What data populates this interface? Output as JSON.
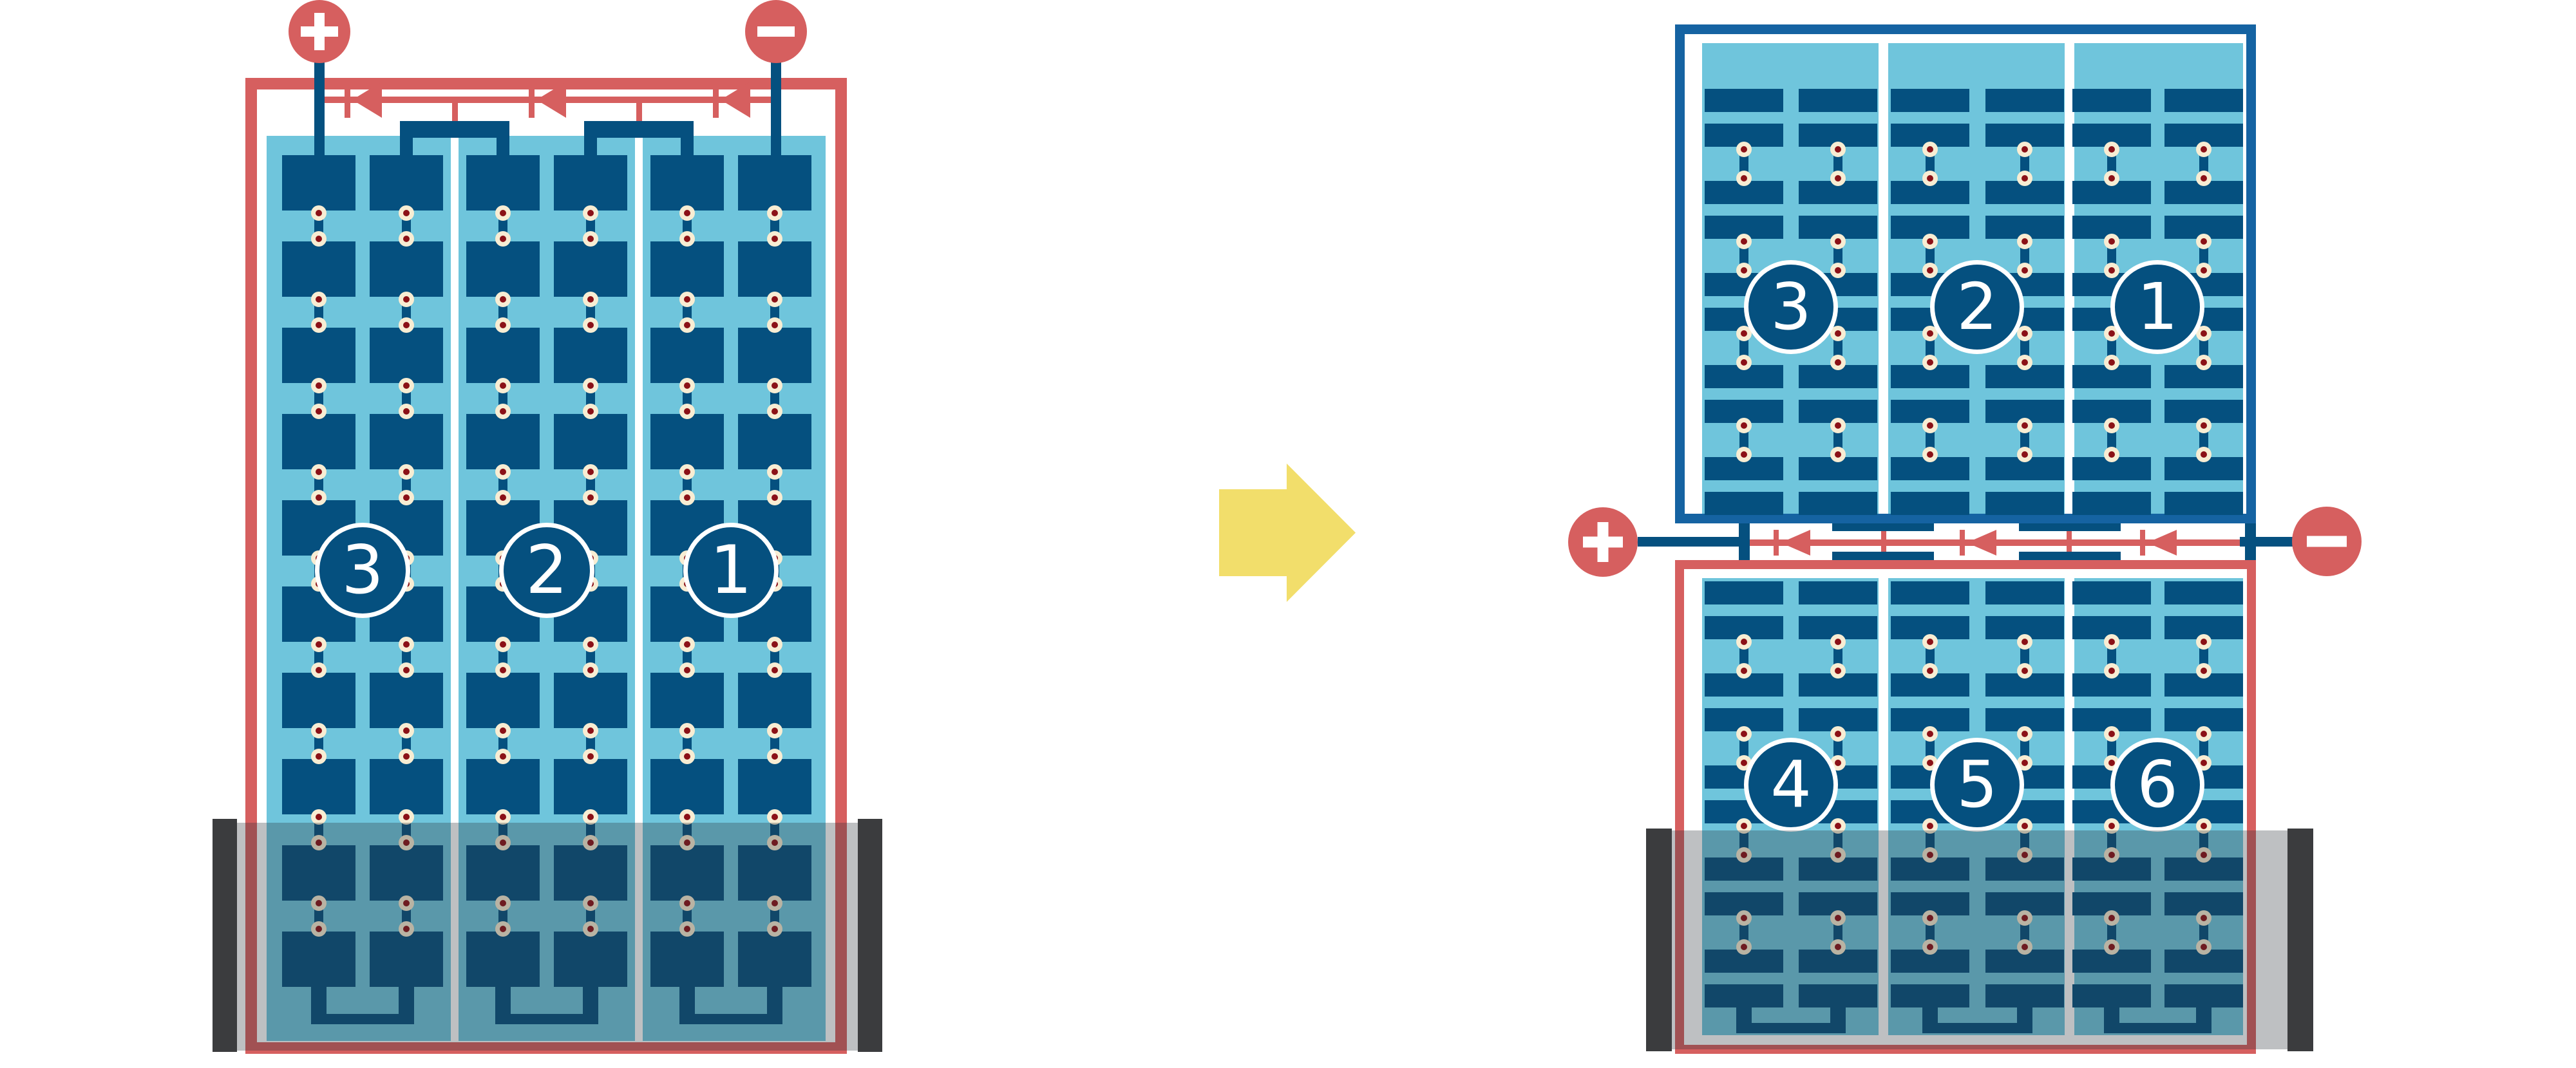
{
  "diagram": {
    "description": "Solar PV module bypass-diode wiring: standard full-cell module with bottom shading compared to half-cut split module",
    "colors": {
      "red": "#D65F5F",
      "cell_blue": "#05507F",
      "frame_blue": "#1563A2",
      "light_blue": "#6FC5DC",
      "solder_cream": "#F8EDD3",
      "solder_maroon": "#8B1117",
      "shade_overlay": "rgba(44,52,58,0.31)",
      "shade_bar": "#3B3C3E",
      "arrow_yellow": "#F2DE6B",
      "background": "#FFFFFF"
    },
    "left_module": {
      "positive_terminal": "+",
      "negative_terminal": "−",
      "bypass_diodes": 3,
      "strings": 3,
      "columns_per_string": 2,
      "cell_rows": 10,
      "string_labels": [
        "3",
        "2",
        "1"
      ],
      "shading": "bottom two cell rows covered by shadow band"
    },
    "transition_arrow": {
      "direction": "right"
    },
    "right_module": {
      "positive_terminal": "+",
      "negative_terminal": "−",
      "bypass_diodes": 3,
      "strings": 3,
      "columns_per_string": 2,
      "top_half": {
        "string_labels": [
          "3",
          "2",
          "1"
        ],
        "cell_pairs_per_column": 5
      },
      "bottom_half": {
        "string_labels": [
          "4",
          "5",
          "6"
        ],
        "cell_pairs_per_column": 5
      },
      "shading": "bottom rows of lower half covered by shadow band"
    }
  }
}
